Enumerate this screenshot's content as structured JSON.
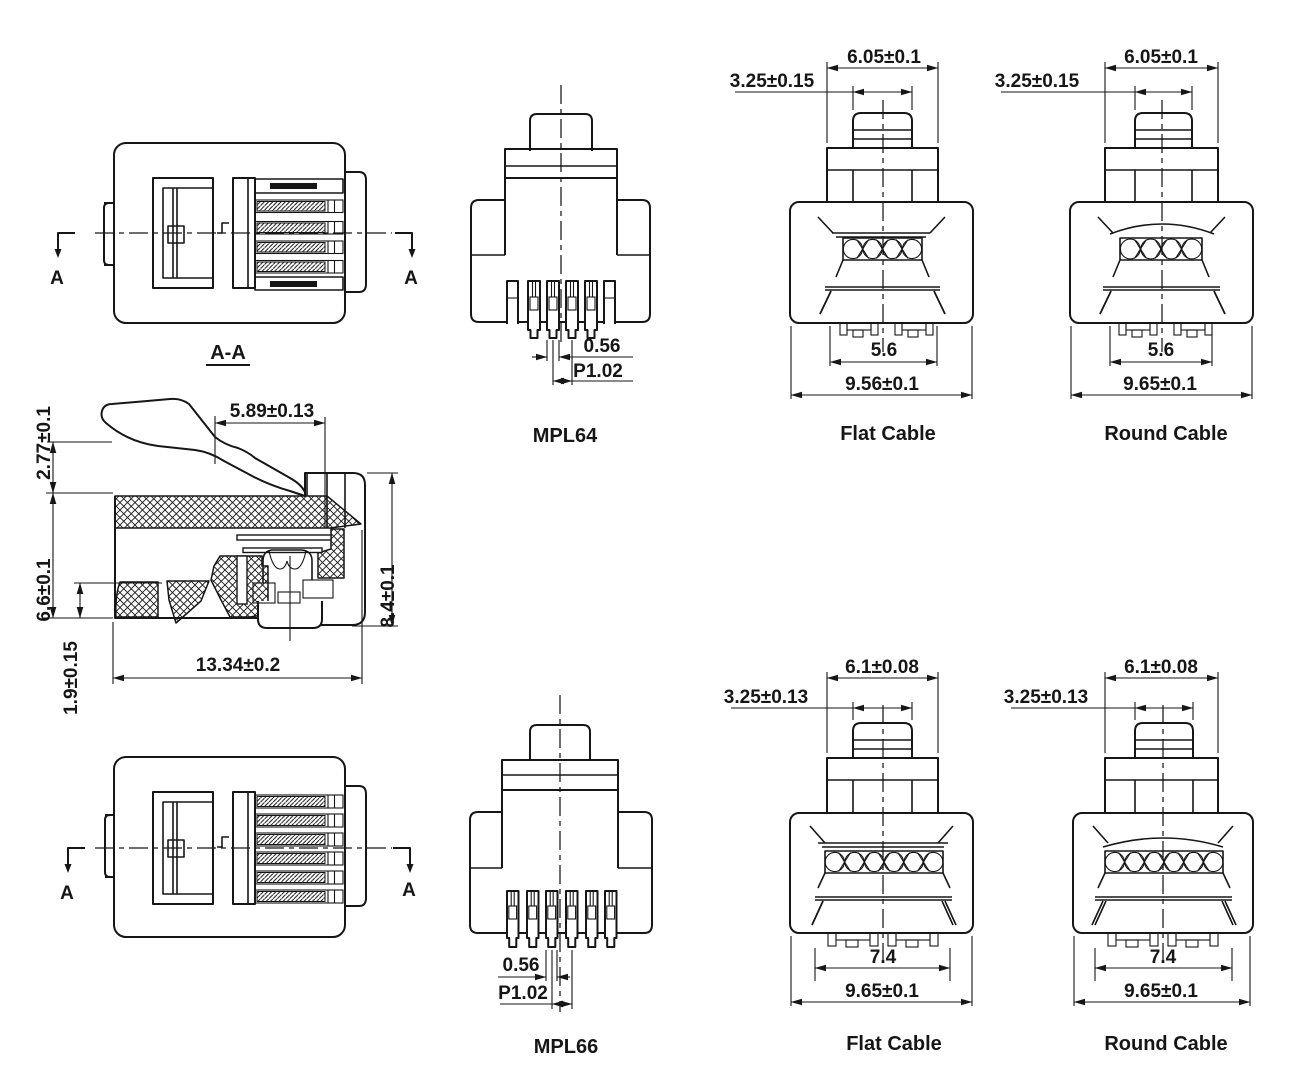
{
  "colors": {
    "line": "#161616",
    "background": "#ffffff"
  },
  "section": {
    "marker": "A",
    "label": "A-A"
  },
  "cross_section": {
    "dims": {
      "latch_height": "2.77±0.1",
      "latch_length": "5.89±0.13",
      "body_height": "6.6±0.1",
      "overall_height": "8.4±0.1",
      "nose_height": "1.9±0.15",
      "overall_length": "13.34±0.2"
    }
  },
  "mpl64": {
    "label": "MPL64",
    "dims": {
      "pin_width": "0.56",
      "pin_pitch": "P1.02"
    }
  },
  "mpl66": {
    "label": "MPL66",
    "dims": {
      "pin_width": "0.56",
      "pin_pitch": "P1.02"
    }
  },
  "flat_cable_64": {
    "label": "Flat Cable",
    "dims": {
      "latch_width": "3.25±0.15",
      "tab_width": "6.05±0.1",
      "contact_span": "5.6",
      "body_width": "9.56±0.1"
    }
  },
  "round_cable_64": {
    "label": "Round Cable",
    "dims": {
      "latch_width": "3.25±0.15",
      "tab_width": "6.05±0.1",
      "contact_span": "5.6",
      "body_width": "9.65±0.1"
    }
  },
  "flat_cable_66": {
    "label": "Flat Cable",
    "dims": {
      "latch_width": "3.25±0.13",
      "tab_width": "6.1±0.08",
      "contact_span": "7.4",
      "body_width": "9.65±0.1"
    }
  },
  "round_cable_66": {
    "label": "Round Cable",
    "dims": {
      "latch_width": "3.25±0.13",
      "tab_width": "6.1±0.08",
      "contact_span": "7.4",
      "body_width": "9.65±0.1"
    }
  }
}
